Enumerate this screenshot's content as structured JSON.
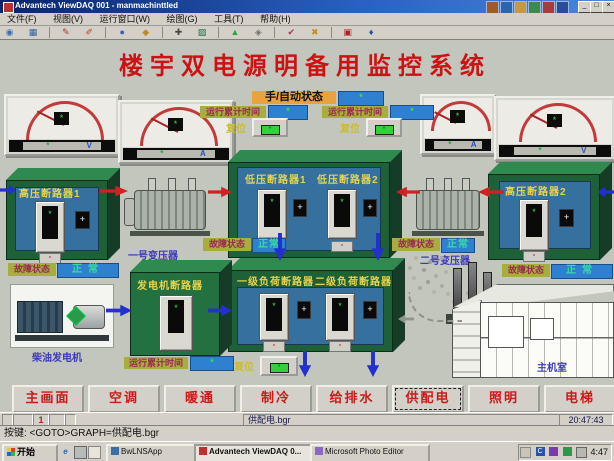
{
  "window": {
    "title": "Advantech ViewDAQ 001 - manmachinttled",
    "menu": [
      "文件(F)",
      "视图(V)",
      "运行窗口(W)",
      "绘图(G)",
      "工具(T)",
      "帮助(H)"
    ],
    "controls": {
      "minimize": "_",
      "maximize": "□",
      "close": "×"
    }
  },
  "toolbar": {
    "icons": [
      "◉",
      "▦",
      "✎",
      "✐",
      "●",
      "◆",
      "✚",
      "▨",
      "▲",
      "◈",
      "✔",
      "✖",
      "▣",
      "♦"
    ]
  },
  "hmi": {
    "title": "楼宇双电源明备用监控系统",
    "mode_label": "手/自动状态",
    "mode_value": "*",
    "runtime_label_1": "运行累计时间",
    "runtime_value_1": "*",
    "runtime_label_2": "运行累计时间",
    "runtime_value_2": "*",
    "reset_label_1": "复位",
    "reset_label_2": "复位",
    "reset_label_3": "复位",
    "lamp_glyph": "*",
    "gauges": {
      "value": "*",
      "units": [
        "V",
        "A",
        "A",
        "V"
      ]
    },
    "breakers": {
      "hv1": "高压断路器1",
      "hv2": "高压断路器2",
      "lv1": "低压断路器1",
      "lv2": "低压断路器2",
      "load1": "一级负荷断路器",
      "load2": "二级负荷断路器",
      "gen": "发电机断路器",
      "display": "*",
      "side_btn": "+",
      "trip_btn": "-"
    },
    "status_label": "故障状态",
    "status_normal": "正常",
    "captions": {
      "transformer1": "一号变压器",
      "transformer2": "二号变压器",
      "generator": "柴油发电机",
      "building": "主机室"
    },
    "gen_runtime_label": "运行累计时间",
    "gen_runtime_value": "*"
  },
  "nav": {
    "items": [
      {
        "label": "主画面"
      },
      {
        "label": "空调"
      },
      {
        "label": "暖通"
      },
      {
        "label": "制冷"
      },
      {
        "label": "给排水"
      },
      {
        "label": "供配电"
      },
      {
        "label": "照明"
      },
      {
        "label": "电梯"
      }
    ],
    "active_index": 5
  },
  "statusbar": {
    "page": "1",
    "file": "供配电.bgr",
    "time": "20:47:43"
  },
  "command_line": "按键: <GOTO>GRAPH=供配电.bgr",
  "taskbar": {
    "start_label": "开始",
    "app1": "BwLNSApp",
    "app2": "Advantech ViewDAQ 0...",
    "app3": "Microsoft Photo Editor",
    "tray_time": "4:47"
  }
}
